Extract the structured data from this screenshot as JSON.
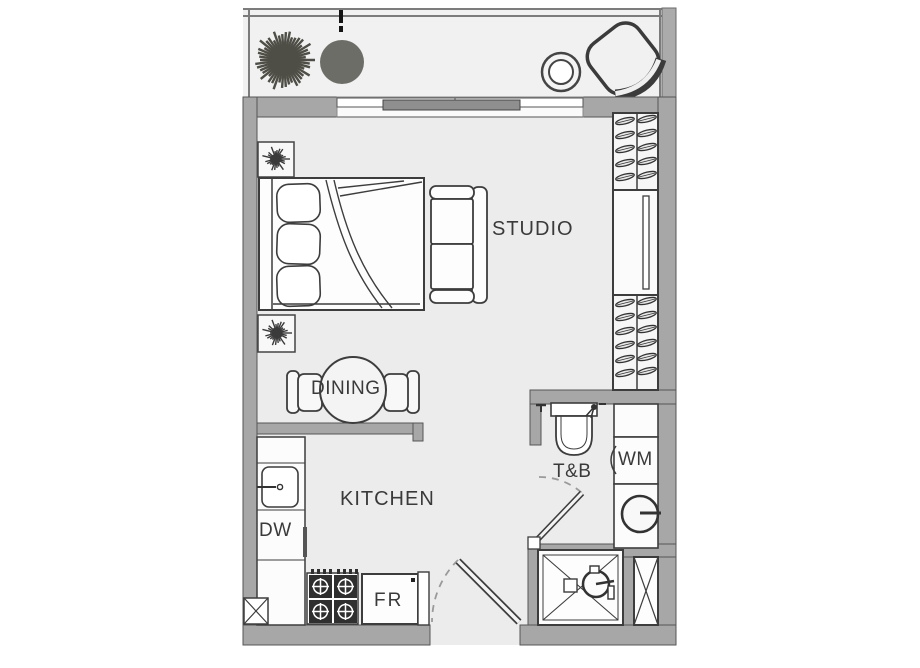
{
  "rooms": {
    "studio": {
      "label": "STUDIO"
    },
    "dining": {
      "label": "DINING"
    },
    "kitchen": {
      "label": "KITCHEN"
    },
    "toilet_bath": {
      "label": "T&B"
    }
  },
  "appliances": {
    "washing_machine": {
      "label": "WM"
    },
    "dishwasher": {
      "label": "DW"
    },
    "fridge": {
      "label": "FR"
    }
  },
  "icons": {
    "balcony": [
      "plant-icon",
      "stool-icon",
      "ring-table-icon",
      "lounge-chair-icon"
    ],
    "studio": [
      "bed-icon",
      "pillow-icon",
      "nightstand-plant-icon",
      "sofa-icon",
      "wardrobe-hanger-icon",
      "mirror-icon"
    ],
    "bath": [
      "toilet-icon",
      "shower-icon",
      "basin-icon",
      "door-swing-icon",
      "utility-shaft-icon"
    ],
    "kitchen": [
      "sink-icon",
      "stove-icon",
      "door-swing-icon"
    ]
  },
  "colors": {
    "wall": "#a7a7a7",
    "floor": "#ececec",
    "balcony_floor": "#f1f1f1",
    "outline": "#3d3d3d",
    "plant": "#4e4e46",
    "stool": "#6d6d68",
    "label_text": "#3a3a3a",
    "background": "#ffffff"
  }
}
